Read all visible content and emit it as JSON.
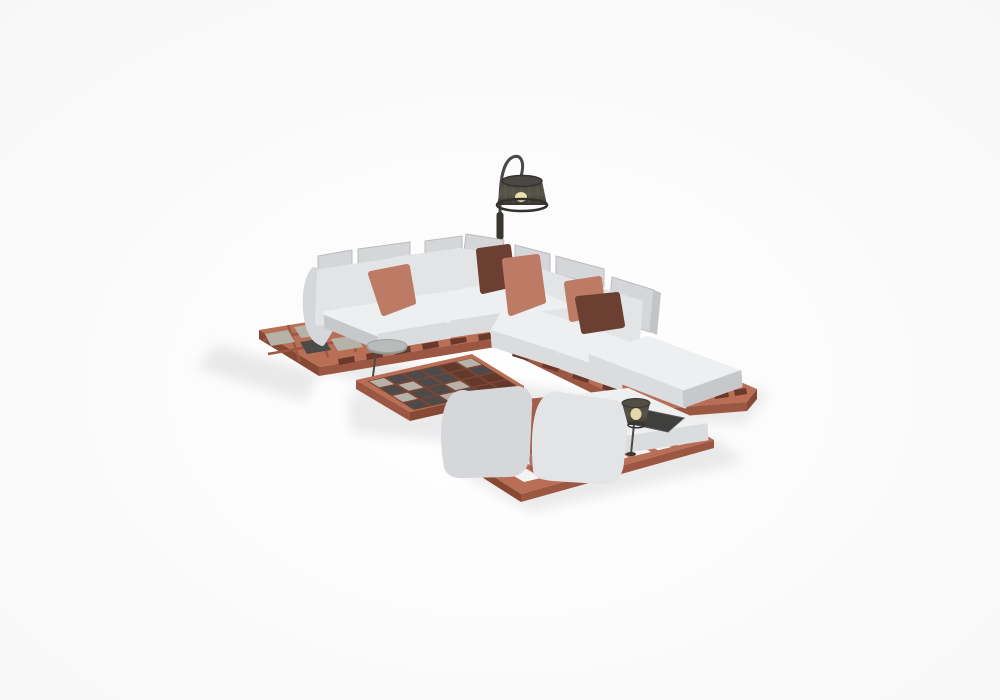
{
  "meta": {
    "alt": "3D render of an outdoor modular corner sofa set: light grey cushions on terracotta slatted wood platforms, terracotta and brown throw pillows, a checkered-top coffee table, a round side table, an arc floor lamp and a lounger module with a small mesh table lamp, on a white studio background"
  },
  "palette": {
    "floor": "#ffffff",
    "floor_edge": "#f7f7f8",
    "shadow": "#d8d9db",
    "cushion_top": "#edeff0",
    "cushion_front": "#dadcde",
    "cushion_side": "#c6c8cb",
    "cushion_soft": "#e2e4e6",
    "cushion_shade": "#d5d7da",
    "panel": "#d4d6d8",
    "panel_edge": "#babcbf",
    "wood_top": "#b96f55",
    "wood_front": "#9c5743",
    "wood_side": "#874834",
    "wood_inner": "#7c4434",
    "wood_gap": "#693a2b",
    "pillow_salmon": "#bd7a64",
    "pillow_salmon_dk": "#a15f4b",
    "pillow_brown": "#6b4033",
    "tile_dark": "#4c4b49",
    "tile_light": "#b6b2a8",
    "tile_void": "#63392c",
    "metal": "#4b4945",
    "lamp_dark": "#38362f",
    "lamp_mesh": "#5a564c",
    "lamp_glow": "#ecdfae",
    "side_table": "#b9bbba",
    "side_table_dk": "#929495",
    "tray": "#3f3f3d"
  },
  "scene": {
    "objects": [
      "corner-sectional-sofa",
      "left-sofa-wing",
      "right-sofa-wing",
      "chaise-ottoman",
      "throw-pillows",
      "slatted-platform-left",
      "slatted-platform-right",
      "checkered-coffee-table",
      "round-side-table",
      "arc-floor-lamp",
      "lounger-module",
      "table-lamp"
    ]
  },
  "coffee_table": {
    "grid": [
      "ldddvl",
      "dlddvd",
      "lddlvv",
      "ddldvv"
    ]
  }
}
